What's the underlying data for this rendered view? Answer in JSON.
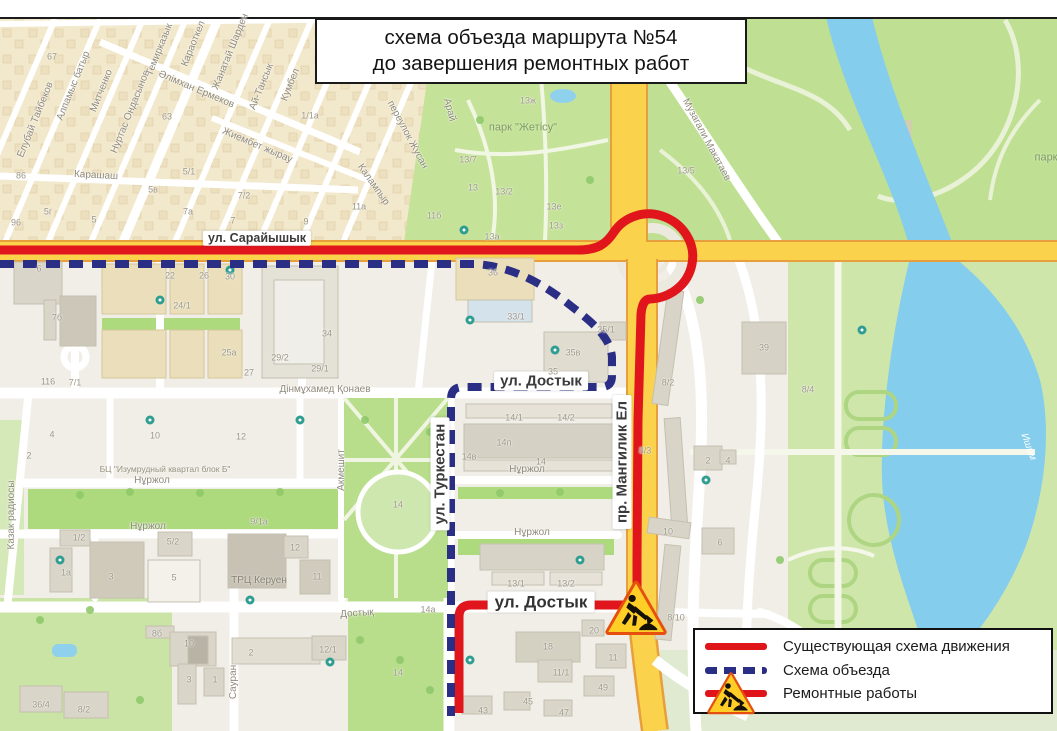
{
  "title": {
    "line1": "схема объезда маршрута №54",
    "line2": "до завершения ремонтных работ"
  },
  "legend": {
    "items": [
      {
        "label": "Существующая схема движения",
        "cls": "red-solid"
      },
      {
        "label": "Схема объезда",
        "cls": "blue-dashed"
      },
      {
        "label": "Ремонтные работы",
        "cls": "roadworks"
      }
    ]
  },
  "colors": {
    "existing_route": "#e0161c",
    "detour_route": "#2b2e85",
    "highway": "#fbd24b",
    "water": "#85cdec",
    "park": "#bfe093",
    "residential": "#f2e8cb"
  },
  "map": {
    "street_labels": [
      {
        "text": "ул. Сарайышык",
        "x": 257,
        "y": 238,
        "rot": 0,
        "cls": "big-sm"
      },
      {
        "text": "ул. Достык",
        "x": 541,
        "y": 381,
        "rot": 0,
        "cls": "big"
      },
      {
        "text": "ул. Достык",
        "x": 541,
        "y": 602,
        "rot": 0,
        "cls": "big-lg"
      },
      {
        "text": "ул. Туркестан",
        "x": 440,
        "y": 474,
        "rot": -90,
        "cls": "big"
      },
      {
        "text": "пр. Мангилик Ел",
        "x": 622,
        "y": 462,
        "rot": -90,
        "cls": "big"
      },
      {
        "text": "Елубай Тайбеков",
        "x": 36,
        "y": 120,
        "rot": -68,
        "cls": "st"
      },
      {
        "text": "Алпамыс батыр",
        "x": 74,
        "y": 86,
        "rot": -68,
        "cls": "st"
      },
      {
        "text": "Митченко",
        "x": 102,
        "y": 91,
        "rot": -68,
        "cls": "st"
      },
      {
        "text": "Нуртас Ондасынов",
        "x": 131,
        "y": 112,
        "rot": -68,
        "cls": "st"
      },
      {
        "text": "Темирказык",
        "x": 160,
        "y": 50,
        "rot": -68,
        "cls": "st"
      },
      {
        "text": "Караоткел",
        "x": 194,
        "y": 44,
        "rot": -68,
        "cls": "st"
      },
      {
        "text": "Жанатай Шарден",
        "x": 231,
        "y": 52,
        "rot": -68,
        "cls": "st"
      },
      {
        "text": "Ай-Тансык",
        "x": 262,
        "y": 87,
        "rot": -68,
        "cls": "st"
      },
      {
        "text": "Кумбел",
        "x": 291,
        "y": 85,
        "rot": -68,
        "cls": "st"
      },
      {
        "text": "Әлімхан Ермеков",
        "x": 196,
        "y": 90,
        "rot": 23,
        "cls": "st"
      },
      {
        "text": "Жиембет жырау",
        "x": 257,
        "y": 146,
        "rot": 23,
        "cls": "st"
      },
      {
        "text": "Карашаш",
        "x": 96,
        "y": 176,
        "rot": 3,
        "cls": "st"
      },
      {
        "text": "переулок Жусан",
        "x": 407,
        "y": 135,
        "rot": 62,
        "cls": "st"
      },
      {
        "text": "Арай",
        "x": 449,
        "y": 110,
        "rot": 75,
        "cls": "st"
      },
      {
        "text": "Калампыр",
        "x": 373,
        "y": 185,
        "rot": 55,
        "cls": "st"
      },
      {
        "text": "Дінмұхамед Қонаев",
        "x": 325,
        "y": 390,
        "rot": 0,
        "cls": "st"
      },
      {
        "text": "Нұржол",
        "x": 152,
        "y": 481,
        "rot": 0,
        "cls": "st"
      },
      {
        "text": "Нұржол",
        "x": 527,
        "y": 470,
        "rot": 0,
        "cls": "st"
      },
      {
        "text": "Нұржол",
        "x": 148,
        "y": 527,
        "rot": 0,
        "cls": "st"
      },
      {
        "text": "Нұржол",
        "x": 532,
        "y": 533,
        "rot": 0,
        "cls": "st"
      },
      {
        "text": "Акмешит",
        "x": 342,
        "y": 470,
        "rot": -90,
        "cls": "st"
      },
      {
        "text": "Сауран",
        "x": 234,
        "y": 682,
        "rot": -90,
        "cls": "st"
      },
      {
        "text": "Казак радиосы",
        "x": 12,
        "y": 515,
        "rot": -90,
        "cls": "st"
      },
      {
        "text": "Достық",
        "x": 357,
        "y": 614,
        "rot": -4,
        "cls": "st"
      },
      {
        "text": "Музагали Макатаев",
        "x": 706,
        "y": 140,
        "rot": 62,
        "cls": "st"
      },
      {
        "text": "парк \"Жетісу\"",
        "x": 523,
        "y": 128,
        "rot": 0,
        "cls": "park"
      },
      {
        "text": "парк",
        "x": 1046,
        "y": 158,
        "rot": 0,
        "cls": "park"
      },
      {
        "text": "Ишим",
        "x": 1028,
        "y": 447,
        "rot": 70,
        "cls": "water"
      },
      {
        "text": "ТРЦ Керуен",
        "x": 259,
        "y": 581,
        "rot": 0,
        "cls": "poi"
      },
      {
        "text": "БЦ \"Изумрудный квартал блок Б\"",
        "x": 165,
        "y": 469,
        "rot": 0,
        "cls": "poi-sm"
      }
    ],
    "building_numbers": [
      {
        "text": "67",
        "x": 52,
        "y": 57
      },
      {
        "text": "63",
        "x": 167,
        "y": 117
      },
      {
        "text": "86",
        "x": 21,
        "y": 176
      },
      {
        "text": "96",
        "x": 16,
        "y": 223
      },
      {
        "text": "5г",
        "x": 48,
        "y": 212
      },
      {
        "text": "5",
        "x": 94,
        "y": 220
      },
      {
        "text": "5в",
        "x": 153,
        "y": 190
      },
      {
        "text": "5/1",
        "x": 189,
        "y": 172
      },
      {
        "text": "7а",
        "x": 188,
        "y": 212
      },
      {
        "text": "7",
        "x": 233,
        "y": 221
      },
      {
        "text": "7/2",
        "x": 244,
        "y": 196
      },
      {
        "text": "9",
        "x": 306,
        "y": 222
      },
      {
        "text": "1/1а",
        "x": 310,
        "y": 116
      },
      {
        "text": "11а",
        "x": 359,
        "y": 207
      },
      {
        "text": "11б",
        "x": 434,
        "y": 216
      },
      {
        "text": "13/7",
        "x": 468,
        "y": 160
      },
      {
        "text": "13",
        "x": 473,
        "y": 188
      },
      {
        "text": "13/2",
        "x": 504,
        "y": 192
      },
      {
        "text": "13е",
        "x": 554,
        "y": 207
      },
      {
        "text": "13з",
        "x": 556,
        "y": 226
      },
      {
        "text": "13а",
        "x": 492,
        "y": 237
      },
      {
        "text": "13ж",
        "x": 528,
        "y": 101
      },
      {
        "text": "13/5",
        "x": 686,
        "y": 171
      },
      {
        "text": "22",
        "x": 170,
        "y": 276
      },
      {
        "text": "26",
        "x": 204,
        "y": 276
      },
      {
        "text": "30",
        "x": 230,
        "y": 277
      },
      {
        "text": "24/1",
        "x": 182,
        "y": 306
      },
      {
        "text": "25а",
        "x": 229,
        "y": 353
      },
      {
        "text": "27",
        "x": 249,
        "y": 373
      },
      {
        "text": "29/2",
        "x": 280,
        "y": 358
      },
      {
        "text": "29/1",
        "x": 320,
        "y": 369
      },
      {
        "text": "34",
        "x": 327,
        "y": 334
      },
      {
        "text": "6",
        "x": 39,
        "y": 269
      },
      {
        "text": "7б",
        "x": 57,
        "y": 318
      },
      {
        "text": "7/1",
        "x": 75,
        "y": 383
      },
      {
        "text": "4",
        "x": 52,
        "y": 435
      },
      {
        "text": "2",
        "x": 29,
        "y": 456
      },
      {
        "text": "10",
        "x": 155,
        "y": 436
      },
      {
        "text": "12",
        "x": 241,
        "y": 437
      },
      {
        "text": "36",
        "x": 493,
        "y": 273
      },
      {
        "text": "33/1",
        "x": 516,
        "y": 317
      },
      {
        "text": "35/1",
        "x": 606,
        "y": 330
      },
      {
        "text": "35в",
        "x": 573,
        "y": 353
      },
      {
        "text": "35",
        "x": 553,
        "y": 372
      },
      {
        "text": "14/1",
        "x": 514,
        "y": 418
      },
      {
        "text": "14/2",
        "x": 566,
        "y": 418
      },
      {
        "text": "14п",
        "x": 504,
        "y": 443
      },
      {
        "text": "14в",
        "x": 469,
        "y": 457
      },
      {
        "text": "14",
        "x": 541,
        "y": 462
      },
      {
        "text": "8/2",
        "x": 668,
        "y": 383
      },
      {
        "text": "8/3",
        "x": 645,
        "y": 451
      },
      {
        "text": "2",
        "x": 708,
        "y": 461
      },
      {
        "text": "4",
        "x": 728,
        "y": 461
      },
      {
        "text": "10",
        "x": 668,
        "y": 532
      },
      {
        "text": "6",
        "x": 720,
        "y": 543
      },
      {
        "text": "8/4",
        "x": 808,
        "y": 390
      },
      {
        "text": "39",
        "x": 764,
        "y": 348
      },
      {
        "text": "8/10",
        "x": 676,
        "y": 618
      },
      {
        "text": "20",
        "x": 594,
        "y": 631
      },
      {
        "text": "18",
        "x": 548,
        "y": 647
      },
      {
        "text": "11",
        "x": 613,
        "y": 658
      },
      {
        "text": "11/1",
        "x": 561,
        "y": 673
      },
      {
        "text": "49",
        "x": 603,
        "y": 688
      },
      {
        "text": "45",
        "x": 528,
        "y": 702
      },
      {
        "text": "43",
        "x": 483,
        "y": 711
      },
      {
        "text": "47",
        "x": 564,
        "y": 713
      },
      {
        "text": "13/1",
        "x": 516,
        "y": 584
      },
      {
        "text": "13/2",
        "x": 566,
        "y": 584
      },
      {
        "text": "1/2",
        "x": 79,
        "y": 538
      },
      {
        "text": "1а",
        "x": 66,
        "y": 573
      },
      {
        "text": "3",
        "x": 111,
        "y": 577
      },
      {
        "text": "5/2",
        "x": 173,
        "y": 542
      },
      {
        "text": "5",
        "x": 174,
        "y": 578
      },
      {
        "text": "12",
        "x": 295,
        "y": 548
      },
      {
        "text": "11",
        "x": 317,
        "y": 577
      },
      {
        "text": "9/1а",
        "x": 259,
        "y": 522
      },
      {
        "text": "8б",
        "x": 157,
        "y": 634
      },
      {
        "text": "10",
        "x": 189,
        "y": 644
      },
      {
        "text": "3",
        "x": 189,
        "y": 680
      },
      {
        "text": "1",
        "x": 215,
        "y": 680
      },
      {
        "text": "2",
        "x": 251,
        "y": 653
      },
      {
        "text": "12/1",
        "x": 328,
        "y": 650
      },
      {
        "text": "8/2",
        "x": 84,
        "y": 710
      },
      {
        "text": "36/4",
        "x": 41,
        "y": 705
      },
      {
        "text": "14",
        "x": 398,
        "y": 505
      },
      {
        "text": "14а",
        "x": 428,
        "y": 610
      },
      {
        "text": "14",
        "x": 398,
        "y": 673
      },
      {
        "text": "116",
        "x": 48,
        "y": 382
      }
    ]
  }
}
